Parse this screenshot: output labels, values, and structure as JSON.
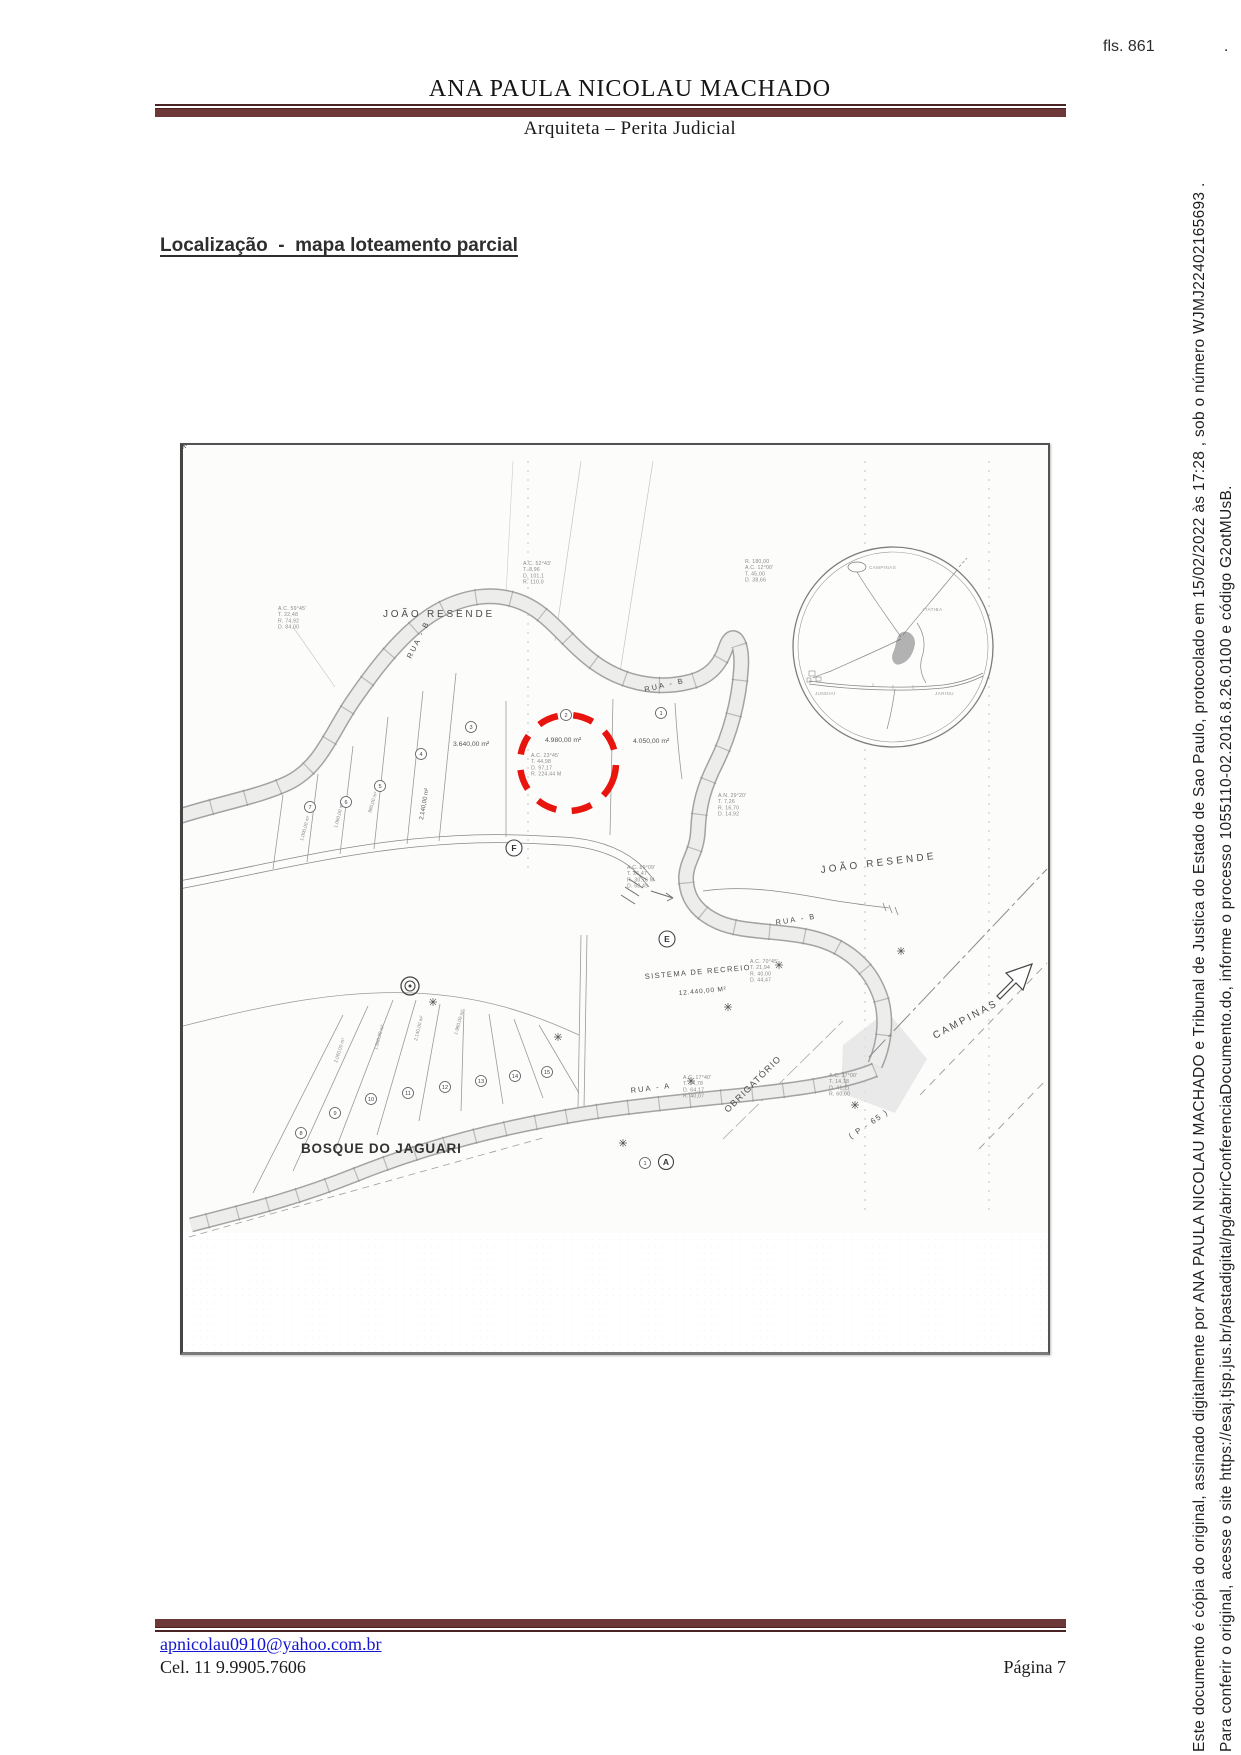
{
  "page": {
    "fls": "fls. 861",
    "pagina": "Página 7"
  },
  "header": {
    "title": "ANA PAULA NICOLAU MACHADO",
    "subtitle": "Arquiteta – Perita Judicial"
  },
  "section": {
    "heading": "Localização  -  mapa loteamento parcial"
  },
  "footer": {
    "email": "apnicolau0910@yahoo.com.br",
    "phone": "Cel. 11 9.9905.7606"
  },
  "stamp": {
    "line1": "Este documento é cópia do original, assinado digitalmente por ANA PAULA NICOLAU MACHADO e Tribunal de Justica do Estado de Sao Paulo, protocolado em 15/02/2022 às 17:28 , sob o número WJMJ22402165693 .",
    "line2": "Para conferir o original, acesse o site https://esaj.tjsp.jus.br/pastadigital/pg/abrirConferenciaDocumento.do, informe o processo 1055110-02.2016.8.26.0100 e código G2otMUsB.",
    "dot": "."
  },
  "map": {
    "region_labels": {
      "joao_resende_top": "JOÃO RESENDE",
      "joao_resende_right": "JOÃO RESENDE",
      "bosque": "BOSQUE DO JAGUARI",
      "campinas": "CAMPINAS",
      "obrigatorio": "OBRIGATÓRIO",
      "p65": "( P - 65 )",
      "sistema1": "SISTEMA  DE  RECREIO",
      "sistema2": "12.440,00 M²"
    },
    "street_labels": {
      "rua_b_top": "RUA - B",
      "rua_b_left": "RUA - B",
      "rua_b_lower": "RUA - B",
      "rua_a": "RUA - A"
    },
    "lot_areas": {
      "left": "3.640,00 m²",
      "highlight": "4.980,00 m²",
      "right": "4.050,00 m²",
      "tall": "2.140,00 m²"
    },
    "block_letters": {
      "f": "F",
      "e": "E",
      "a": "A"
    },
    "lot_numbers": {
      "top": [
        "7",
        "6",
        "5",
        "4",
        "3",
        "2",
        "1"
      ],
      "bottom": [
        "8",
        "9",
        "10",
        "11",
        "12",
        "13",
        "14",
        "15"
      ],
      "pair": "1"
    },
    "fan_area_labels": [
      "1.000,00 m²",
      "1.060,00 m²",
      "980,00 m²",
      "2.060,00 m²",
      "1.940,00 m²",
      "2.140,00 m²",
      "1.980,00 m²"
    ],
    "annotations": {
      "c1": {
        "lines": [
          "A.C. 59°45'",
          "T. 22,48",
          "R. 74,92",
          "D. 84,00"
        ]
      },
      "c2": {
        "lines": [
          "A.C. 52°43'",
          "T. 8,96",
          "D. 101,1",
          "R. 110,0"
        ]
      },
      "c3": {
        "lines": [
          "R. 180,00",
          "A.C. 12°00'",
          "T. 45,00",
          "D. 38,66"
        ]
      },
      "c4": {
        "lines": [
          "A.C. 23°45'",
          "T. 44,98",
          "D. 97,17",
          "R. 224,44 M"
        ]
      },
      "c5": {
        "lines": [
          "A.C. 89°09'",
          "T. 26,47",
          "R. 30,76 M",
          "D. 58,49"
        ]
      },
      "c6": {
        "lines": [
          "A.N. 29°20'",
          "T. 7,26",
          "R. 16,70",
          "D. 14,92"
        ]
      },
      "c7": {
        "lines": [
          "A.C. 70°45'",
          "T. 21,94",
          "R. 40,00",
          "D. 44,47"
        ]
      },
      "c8": {
        "lines": [
          "A.C. 17°40'",
          "T. 34,78",
          "D. 64,17",
          "R. 40,07"
        ]
      },
      "c9": {
        "lines": [
          "A.C. 37°00'",
          "T. 14,78",
          "D. 41,11",
          "R. 60,00"
        ]
      }
    },
    "inset_labels": [
      "CAMPINAS",
      "ITATIBA",
      "JUNDIAÍ",
      "JARINU"
    ],
    "colors": {
      "highlight_red": "#e8150f",
      "rule_maroon": "#6e3838",
      "link_blue": "#1515cf"
    }
  }
}
